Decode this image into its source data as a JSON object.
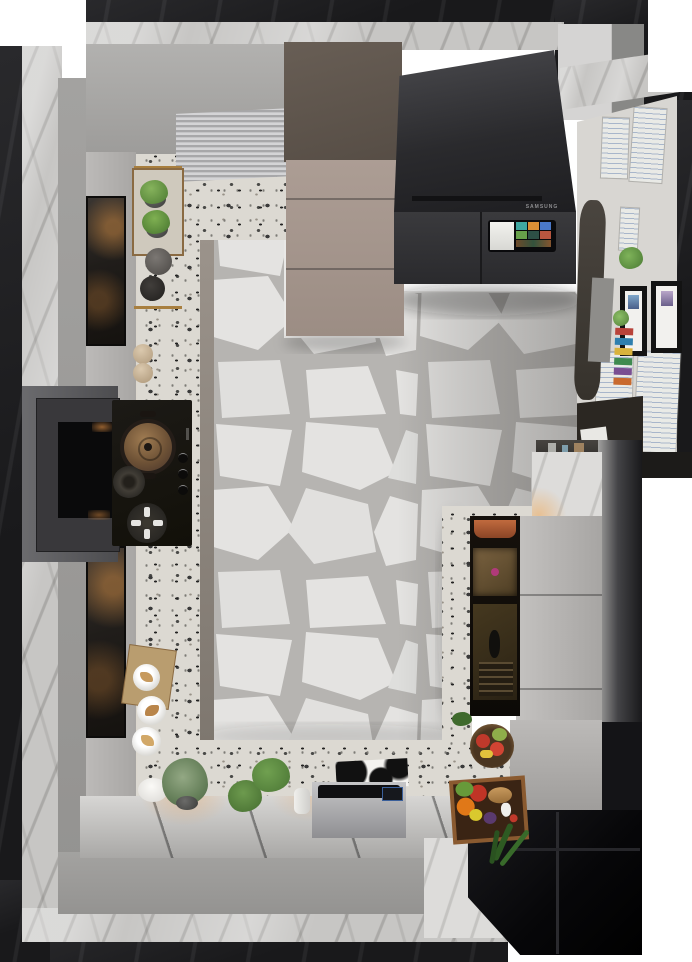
{
  "scene": {
    "type": "3d-render",
    "view": "top-down",
    "room": "modern kitchen",
    "description": "Photorealistic bird's-eye render of a U-shaped kitchen: terrazzo countertops, crazy-paving marble floor, black smart refrigerator with touchscreen, gas cooktop with copper pot, range hood, taupe tall cabinets, open pantry niche, decor plants, pastries, fruit bowl and vegetable box, and a styled desk nook with posters and picture frames",
    "fridge": {
      "brand": "SAMSUNG",
      "finish": "black glass",
      "touchscreen": true
    },
    "palette": {
      "background": "#ffffff",
      "outer_wall_dark": "#19191b",
      "marble_light": "#c7c6c4",
      "marble_bright": "#dddcda",
      "wall_gray": "#9c9b99",
      "cabinet_gray": "#b3b1af",
      "cabinet_taupe_front": "#a5968d",
      "cabinet_taupe_top": "#5f564e",
      "terrazzo_base": "#dcd9d2",
      "floor_stone": "#e4e3e1",
      "floor_grout": "#b6b4b1",
      "cooktop_black": "#151310",
      "steel": "#bfbfc1",
      "copper_pot": "#8a6a4a",
      "plant_green": "#55803f",
      "glass_door_black": "#0a0a0c",
      "warm_glow": "#e9964b",
      "nook_wall": "#d8d6d2"
    },
    "objects": [
      "range-hood",
      "gas-cooktop",
      "copper-pot",
      "control-knobs",
      "herb-pots",
      "coffee-grinder",
      "storage-canisters",
      "wall-cabinet-glass-doors",
      "tambour-appliance-garage",
      "tall-taupe-cabinet",
      "smart-refrigerator",
      "touchscreen",
      "desk-nook",
      "posters",
      "picture-frames",
      "books",
      "desk-chair",
      "marble-pillar",
      "pantry-niche",
      "bronze-drawer",
      "tall-gray-door",
      "plates-with-pastries",
      "serving-board",
      "potted-plants",
      "steel-appliance",
      "cow-print-card",
      "fruit-bowl",
      "vegetable-box",
      "black-glass-door",
      "flagstone-floor",
      "terrazzo-counters"
    ]
  }
}
